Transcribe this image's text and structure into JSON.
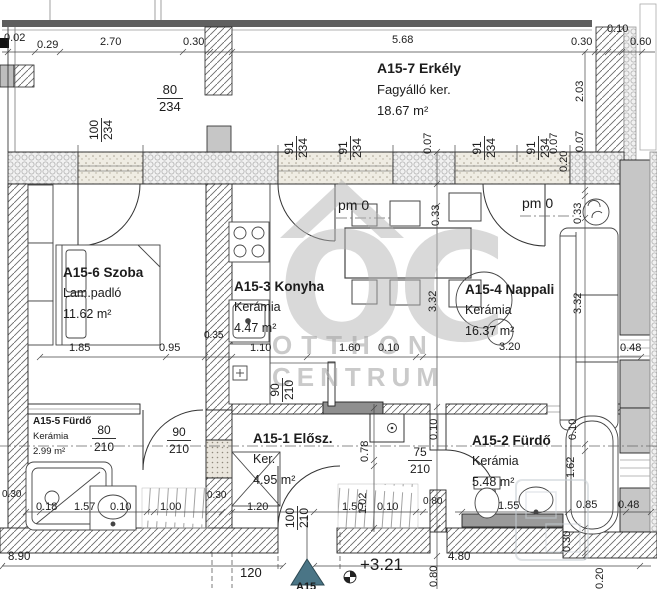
{
  "watermark": {
    "monogram": "OC",
    "line1": "OTTHON",
    "line2": "CENTRUM"
  },
  "rooms": {
    "erkely": {
      "name": "A15-7 Erkély",
      "finish": "Fagyálló ker.",
      "area": "18.67 m²"
    },
    "szoba": {
      "name": "A15-6 Szoba",
      "finish": "Lam.padló",
      "area": "11.62 m²"
    },
    "konyha": {
      "name": "A15-3 Konyha",
      "finish": "Kerámia",
      "area": "4.47 m²"
    },
    "nappali": {
      "name": "A15-4 Nappali",
      "finish": "Kerámia",
      "area": "16.37 m²"
    },
    "furdo_a": {
      "name": "A15-5 Fürdő",
      "finish": "Kerámia",
      "area": "2.99 m²"
    },
    "eloszoba": {
      "name": "A15-1 Elősz.",
      "finish": "Ker.",
      "area": "4.95 m²"
    },
    "furdo_b": {
      "name": "A15-2 Fürdő",
      "finish": "Kerámia",
      "area": "5.48 m²"
    }
  },
  "levels": {
    "balcony_left": "pm 0",
    "balcony_right": "pm 0",
    "entry": "+3.21",
    "section": "A15",
    "marker_color": "#4a7586"
  },
  "openings": {
    "w80_234": {
      "w": "80",
      "h": "234"
    },
    "w100_234": {
      "w": "100",
      "h": "234"
    },
    "w91_234_1": {
      "w": "91",
      "h": "234"
    },
    "w91_234_2": {
      "w": "91",
      "h": "234"
    },
    "w91_234_3": {
      "w": "91",
      "h": "234"
    },
    "w91_234_4": {
      "w": "91",
      "h": "234"
    },
    "d80_210": {
      "w": "80",
      "h": "210"
    },
    "d90_210": {
      "w": "90",
      "h": "210"
    },
    "d90_210_k": {
      "w": "90",
      "h": "210"
    },
    "d75_210": {
      "w": "75",
      "h": "210"
    },
    "d100_210": {
      "w": "100",
      "h": "210"
    }
  },
  "dims": {
    "top": [
      "0.02",
      "0.29",
      "2.70",
      "0.30",
      "5.68",
      "0.30",
      "0.10",
      "0.60"
    ],
    "right": [
      "2.03",
      "0.07",
      "0.20",
      "0.33",
      "3.32",
      "0.48",
      "0.10",
      "1.62",
      "0.85",
      "0.48",
      "0.30",
      "0.20"
    ],
    "interior_v": [
      "0.33",
      "3.32",
      "0.07",
      "0.07",
      "0.78",
      "1.02",
      "0.10",
      "0.80"
    ],
    "room_row": [
      "1.85",
      "0.95",
      "0.35",
      "1.10",
      "1.60",
      "0.10",
      "3.20"
    ],
    "bottom_row": [
      "0.30",
      "0.18",
      "1.57",
      "0.10",
      "1.00",
      "0.30",
      "1.20",
      "1.50",
      "0.10",
      "0.80",
      "1.55"
    ],
    "totals": [
      "8.90",
      "120",
      "4.80"
    ]
  }
}
